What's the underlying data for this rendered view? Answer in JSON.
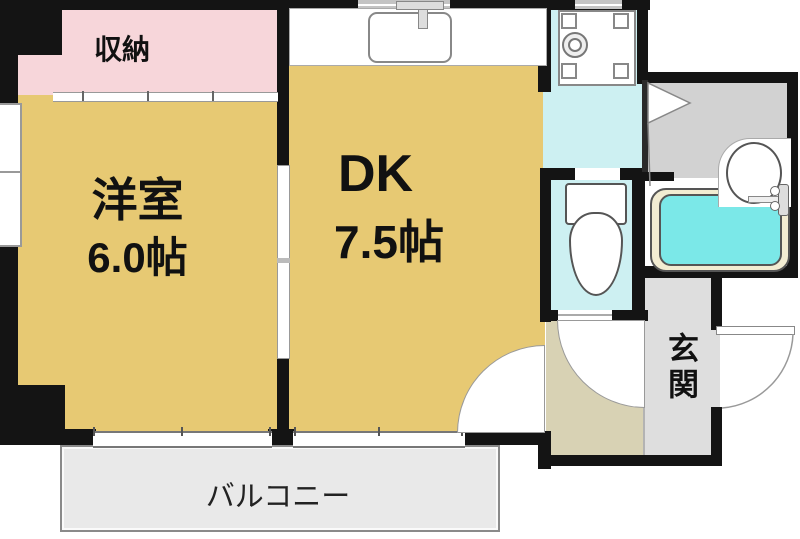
{
  "floorplan": {
    "rooms": {
      "closet": {
        "label": "収納"
      },
      "western_room": {
        "label": "洋室",
        "size": "6.0帖"
      },
      "dining_kitchen": {
        "label": "DK",
        "size": "7.5帖"
      },
      "entrance": {
        "label": "玄関"
      },
      "balcony": {
        "label": "バルコニー"
      }
    },
    "colors": {
      "room_tan": "#e7c973",
      "closet_pink": "#f7d6da",
      "water_cyan": "#cdf0f2",
      "bathtub_fill": "#7be8e8",
      "bathtub_rim": "#f2ecd2",
      "hall_beige": "#d8d2b4",
      "entrance_gray": "#dedede",
      "bath_floor_gray": "#d2d2d2",
      "balcony_gray": "#e9e9e9",
      "wall_black": "#141414"
    }
  }
}
